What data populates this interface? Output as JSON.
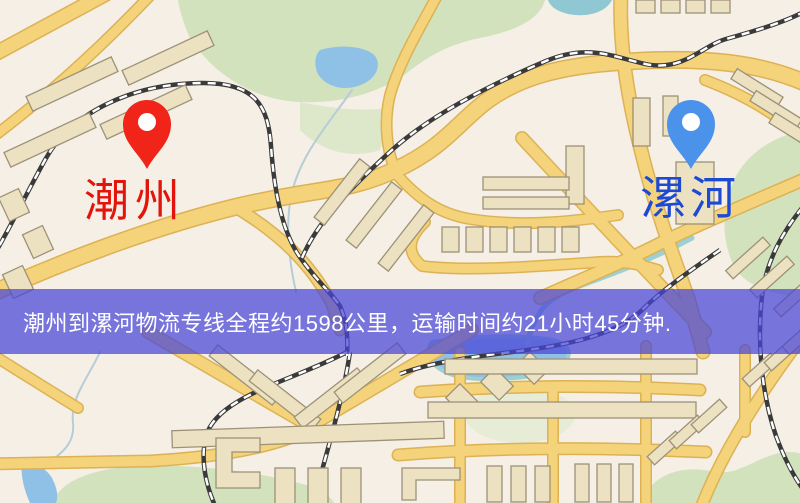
{
  "map": {
    "type": "road-map-illustration",
    "origin": {
      "name": "潮州",
      "pin_color": "#f02418",
      "label_color": "#e2150c"
    },
    "destination": {
      "name": "漯河",
      "pin_color": "#4b92ea",
      "label_color": "#1e4ad2"
    },
    "banner": {
      "text": "潮州到漯河物流专线全程约1598公里，运输时间约21小时45分钟.",
      "background": "#4846d7",
      "opacity": 0.73,
      "text_color": "#ffffff"
    },
    "route": {
      "distance_km": 1598,
      "duration_text": "21小时45分钟"
    },
    "palette": {
      "land": "#f5efe6",
      "road_fill": "#f4d37b",
      "road_casing": "#dcb254",
      "park": "#d2e2bd",
      "water": "#8fc0e6",
      "stream": "#9cd0d4",
      "building_fill": "#ece1c1",
      "building_stroke": "#9d9178",
      "railway": "#3a3a3a"
    }
  }
}
